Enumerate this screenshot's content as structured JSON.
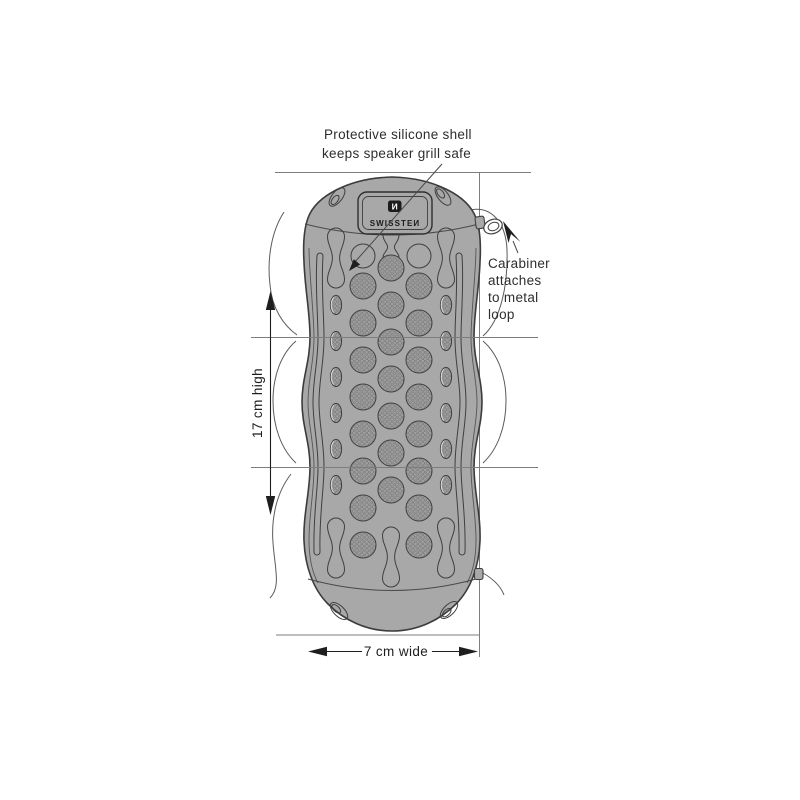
{
  "colors": {
    "background": "#ffffff",
    "body": "#a8a8a8",
    "texture_base": "#9e9e9e",
    "texture_dot": "#767676",
    "outline": "#3c3c3c",
    "reference_line": "#7d7d7d",
    "dimension_ink": "#1e1e1e",
    "logo_bg": "#1c1c1c"
  },
  "device": {
    "brand_text": "SWISSTEИ",
    "logo_glyph": "И"
  },
  "annotations": {
    "shell_note": [
      "Protective silicone shell",
      "keeps speaker grill safe"
    ],
    "carabiner_note": [
      "Carabiner",
      "attaches",
      "to metal",
      "loop"
    ],
    "height_dimension": "17 cm high",
    "width_dimension": "7 cm wide"
  }
}
